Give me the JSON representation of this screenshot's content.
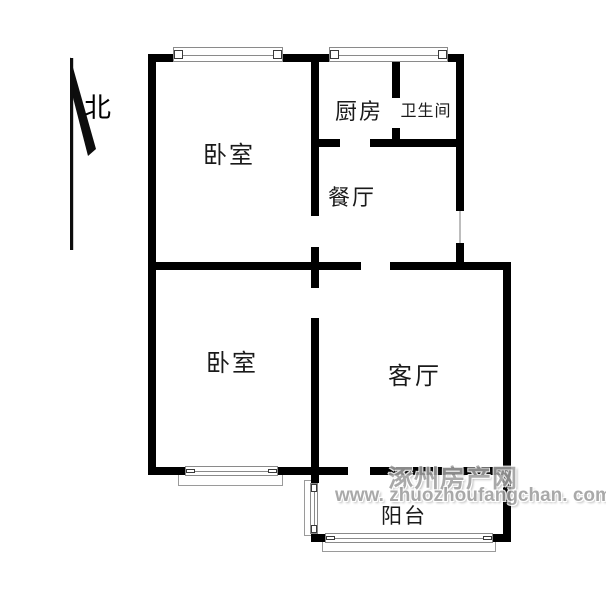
{
  "compass": {
    "label": "北"
  },
  "rooms": {
    "bedroom_top": {
      "label": "卧室"
    },
    "bedroom_bottom": {
      "label": "卧室"
    },
    "kitchen": {
      "label": "厨房"
    },
    "bathroom": {
      "label": "卫生间"
    },
    "dining": {
      "label": "餐厅"
    },
    "living": {
      "label": "客厅"
    },
    "balcony": {
      "label": "阳台"
    }
  },
  "watermark": {
    "site_name": "涿州房产网",
    "site_url": "www. zhuozhoufangchan. com"
  },
  "colors": {
    "wall": "#000000",
    "background": "#ffffff",
    "watermark": "#9e9e9e",
    "window_line": "#8a8a8a"
  }
}
